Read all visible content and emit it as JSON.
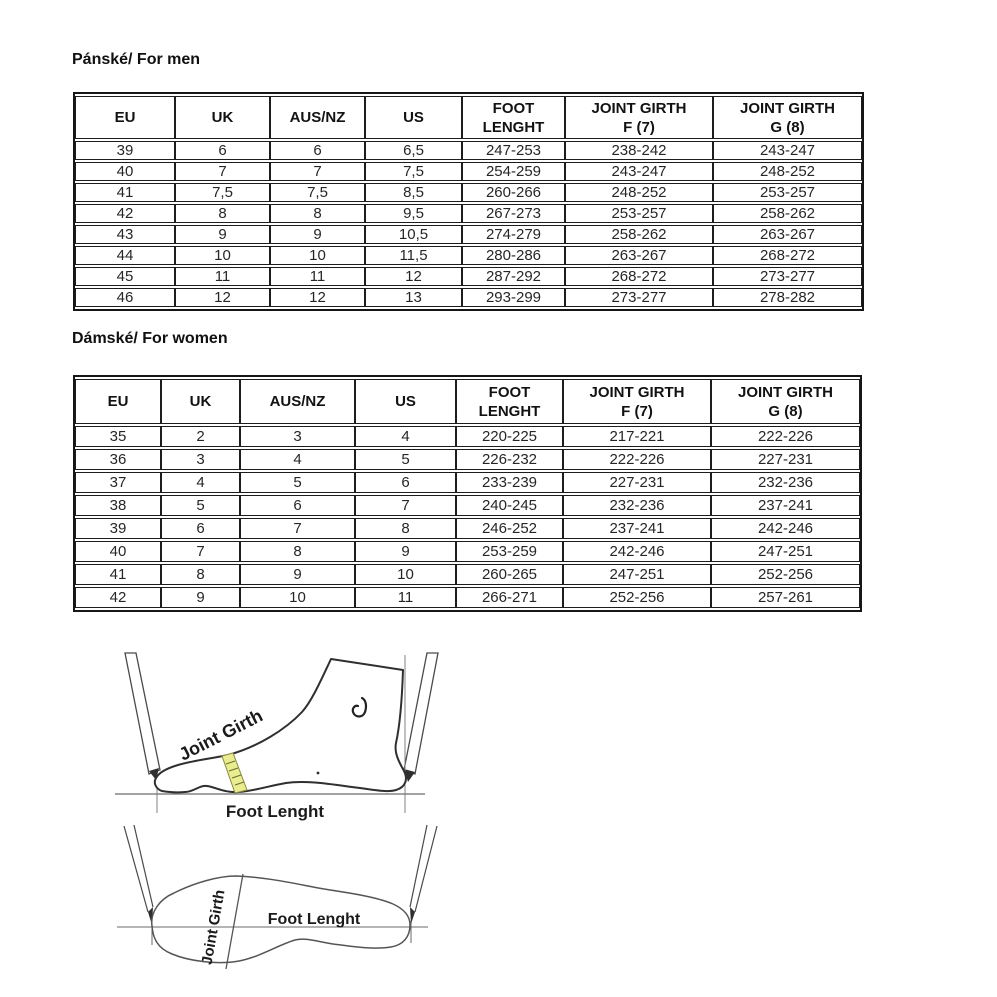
{
  "sections": {
    "men_title": "Pánské/ For men",
    "women_title": "Dámské/ For women"
  },
  "tables": {
    "headers": [
      {
        "l1": "EU",
        "l2": ""
      },
      {
        "l1": "UK",
        "l2": ""
      },
      {
        "l1": "AUS/NZ",
        "l2": ""
      },
      {
        "l1": "US",
        "l2": ""
      },
      {
        "l1": "FOOT",
        "l2": "LENGHT"
      },
      {
        "l1": "JOINT GIRTH",
        "l2": "F (7)"
      },
      {
        "l1": "JOINT GIRTH",
        "l2": "G (8)"
      }
    ],
    "men": {
      "rows": [
        [
          "39",
          "6",
          "6",
          "6,5",
          "247-253",
          "238-242",
          "243-247"
        ],
        [
          "40",
          "7",
          "7",
          "7,5",
          "254-259",
          "243-247",
          "248-252"
        ],
        [
          "41",
          "7,5",
          "7,5",
          "8,5",
          "260-266",
          "248-252",
          "253-257"
        ],
        [
          "42",
          "8",
          "8",
          "9,5",
          "267-273",
          "253-257",
          "258-262"
        ],
        [
          "43",
          "9",
          "9",
          "10,5",
          "274-279",
          "258-262",
          "263-267"
        ],
        [
          "44",
          "10",
          "10",
          "11,5",
          "280-286",
          "263-267",
          "268-272"
        ],
        [
          "45",
          "11",
          "11",
          "12",
          "287-292",
          "268-272",
          "273-277"
        ],
        [
          "46",
          "12",
          "12",
          "13",
          "293-299",
          "273-277",
          "278-282"
        ]
      ]
    },
    "women": {
      "rows": [
        [
          "35",
          "2",
          "3",
          "4",
          "220-225",
          "217-221",
          "222-226"
        ],
        [
          "36",
          "3",
          "4",
          "5",
          "226-232",
          "222-226",
          "227-231"
        ],
        [
          "37",
          "4",
          "5",
          "6",
          "233-239",
          "227-231",
          "232-236"
        ],
        [
          "38",
          "5",
          "6",
          "7",
          "240-245",
          "232-236",
          "237-241"
        ],
        [
          "39",
          "6",
          "7",
          "8",
          "246-252",
          "237-241",
          "242-246"
        ],
        [
          "40",
          "7",
          "8",
          "9",
          "253-259",
          "242-246",
          "247-251"
        ],
        [
          "41",
          "8",
          "9",
          "10",
          "260-265",
          "247-251",
          "252-256"
        ],
        [
          "42",
          "9",
          "10",
          "11",
          "266-271",
          "252-256",
          "257-261"
        ]
      ]
    }
  },
  "diagrams": {
    "side_view": {
      "joint_girth_label": "Joint Girth",
      "foot_length_label": "Foot Lenght"
    },
    "top_view": {
      "joint_girth_label": "Joint Girth",
      "foot_length_label": "Foot Lenght"
    }
  },
  "colors": {
    "measuring_band_yellow": "#e9ec8f",
    "outline_dark": "#2f2f2f",
    "guide_gray": "#6a6a6a"
  }
}
